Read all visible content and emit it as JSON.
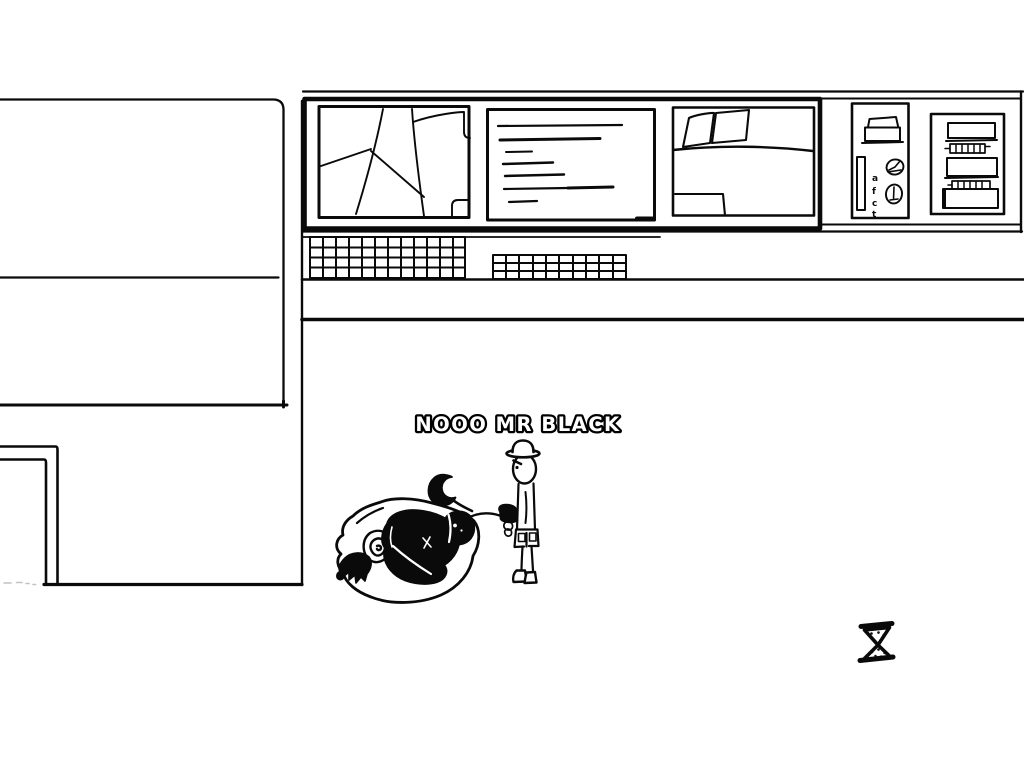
{
  "canvas": {
    "background": "#ffffff",
    "ink": "#0a0a0a",
    "faint_mark_color": "#c2c2c2"
  },
  "dialogue": {
    "caption": "NOOO MR BLACK",
    "text_fill": "#ffffff",
    "text_outline": "#000000"
  },
  "wall_panels": {
    "glyph_panel": {
      "glyphs": [
        "a",
        "f",
        "c",
        "t"
      ]
    }
  },
  "cursor": {
    "icon": "hourglass-icon"
  }
}
